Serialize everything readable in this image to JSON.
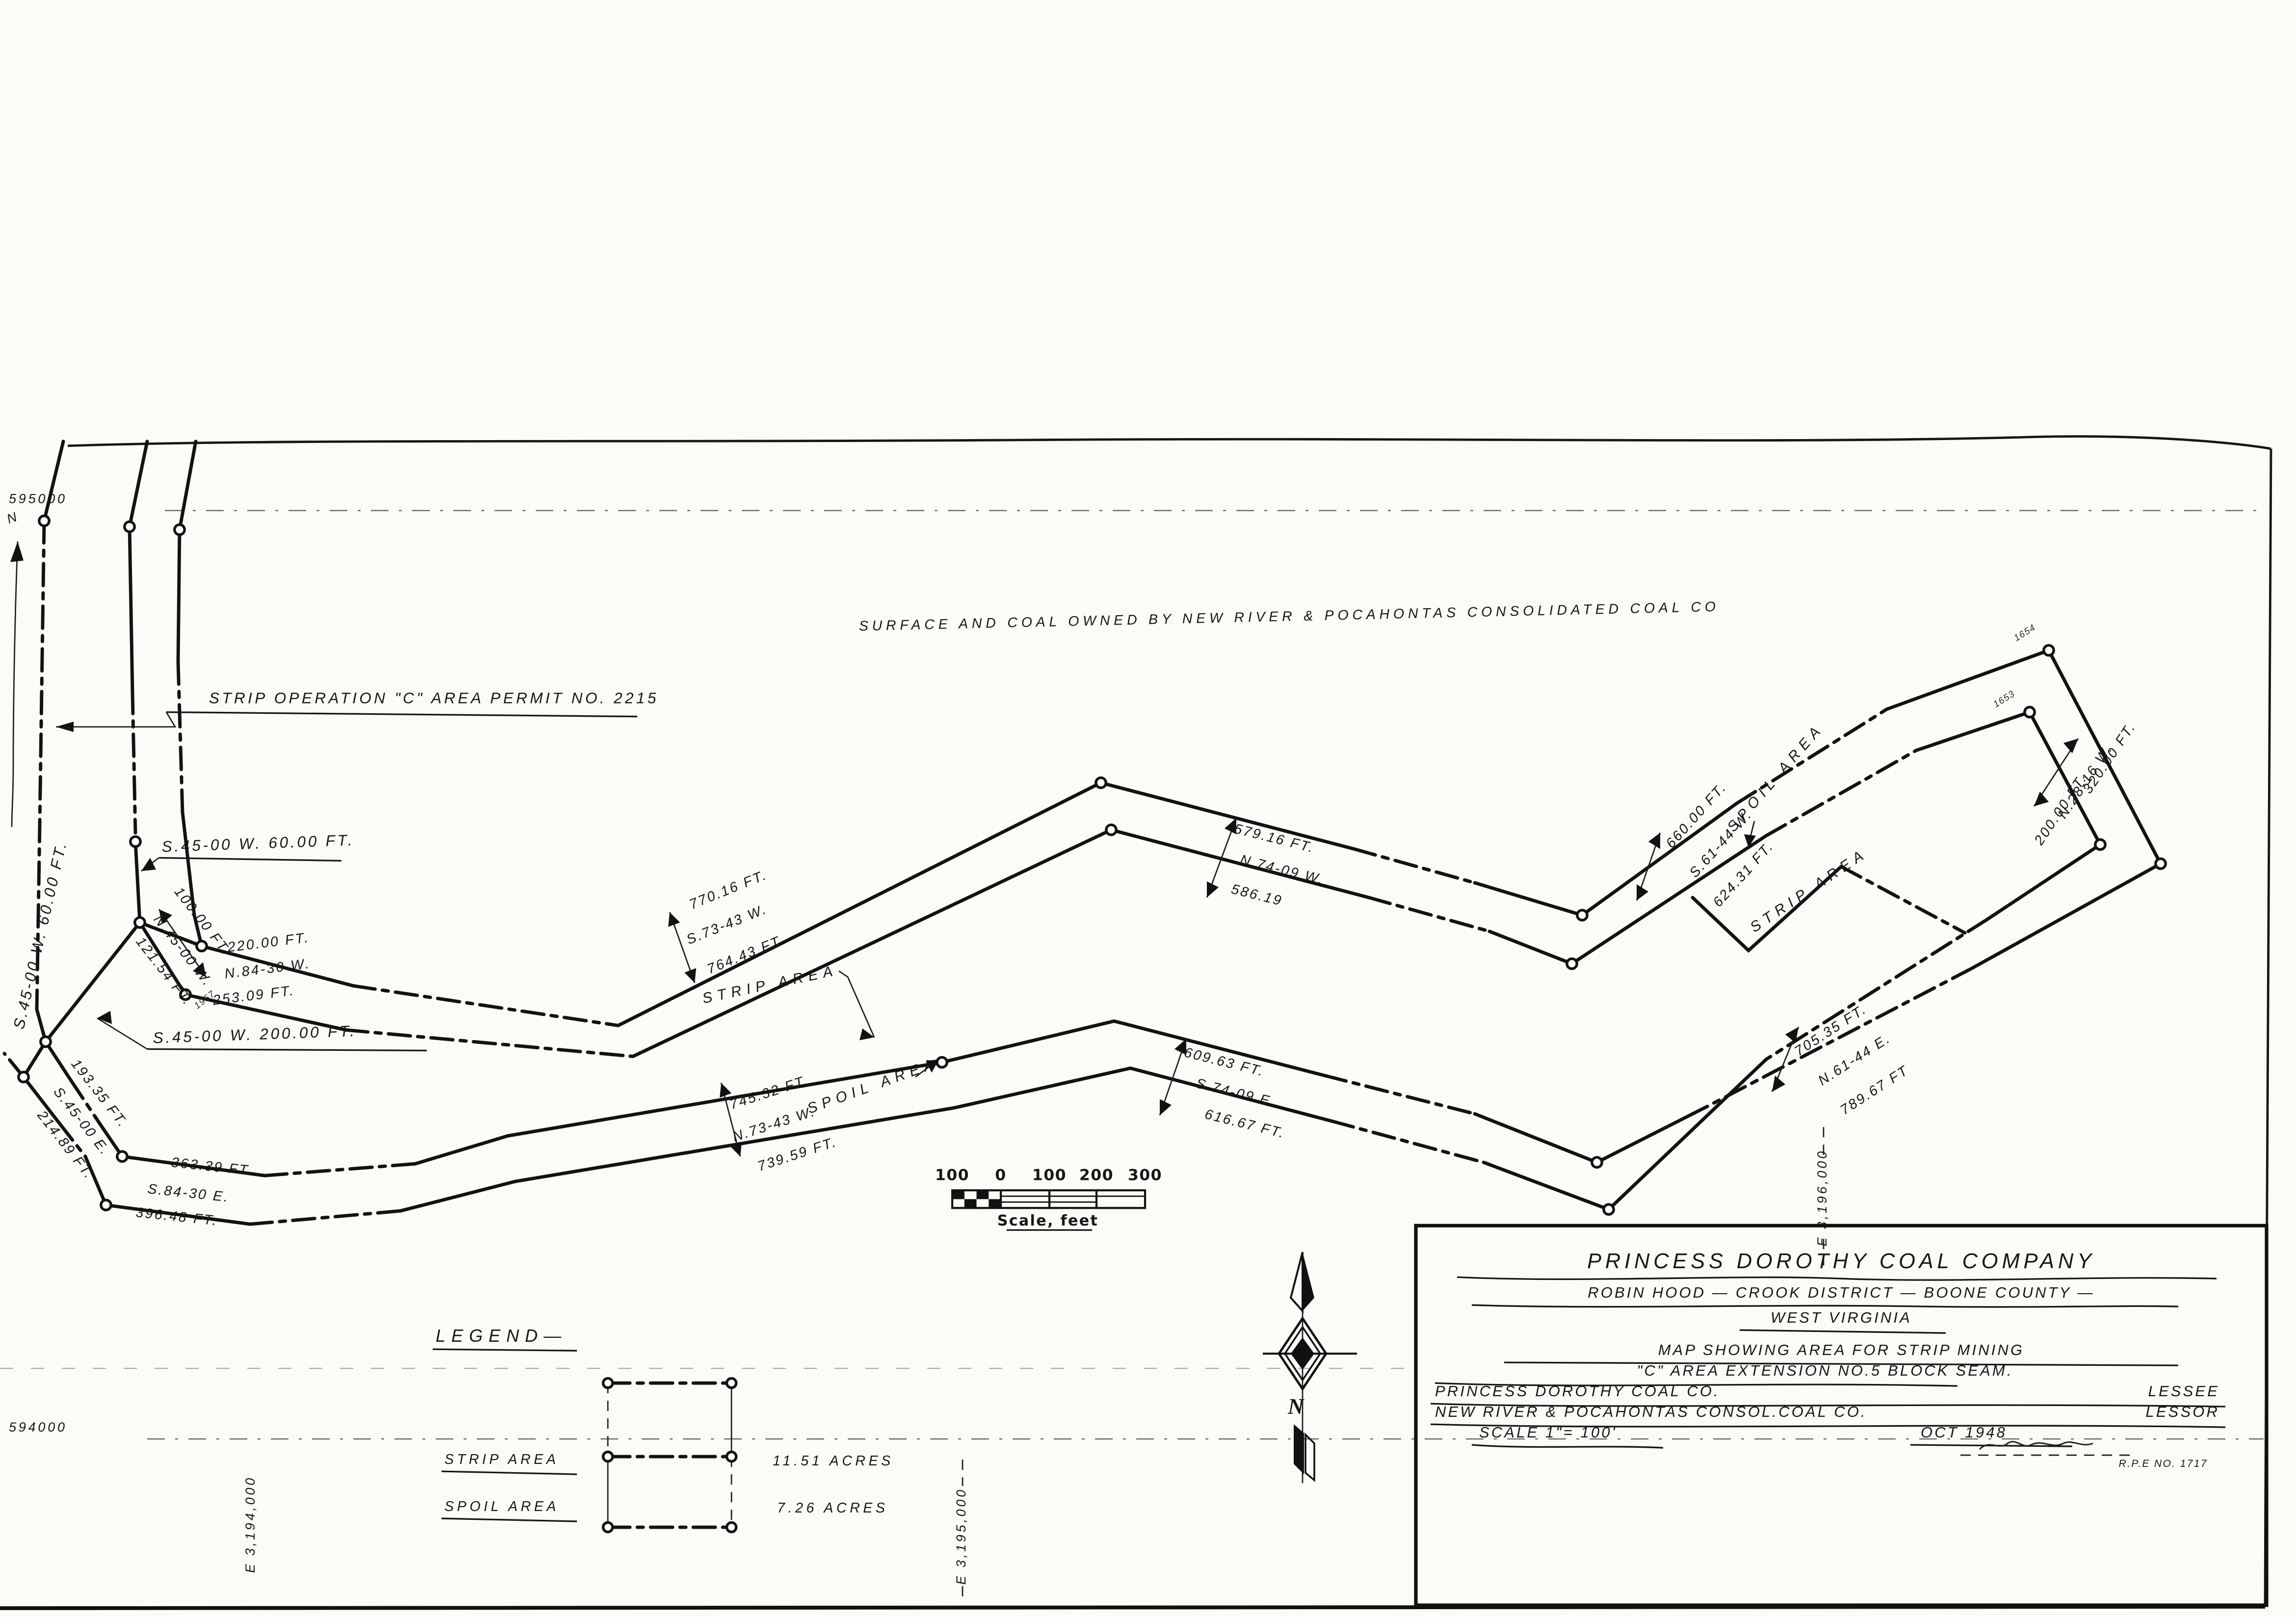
{
  "sheet": {
    "ownership_note": "SURFACE AND COAL OWNED BY NEW RIVER & POCAHONTAS CONSOLIDATED COAL CO",
    "permit_note": "STRIP OPERATION \"C\" AREA PERMIT NO. 2215"
  },
  "grid_labels": {
    "n595": "595000",
    "n594": "594000",
    "e3194": "E 3,194,000",
    "e3195": "E 3,195,000",
    "e3196": "E 3,196,000"
  },
  "compass": {
    "north_small": "N",
    "north_large": "N"
  },
  "scale_bar": {
    "ticks": [
      "100",
      "0",
      "100",
      "200",
      "300"
    ],
    "caption": "Scale, feet"
  },
  "legend": {
    "title": "LEGEND—",
    "items": [
      {
        "label": "STRIP AREA",
        "value": "11.51 ACRES"
      },
      {
        "label": "SPOIL AREA",
        "value": "7.26 ACRES"
      }
    ]
  },
  "area_labels": {
    "strip_left": "STRIP AREA",
    "spoil_left": "SPOIL AREA",
    "spoil_right": "SPOIL AREA",
    "strip_right": "STRIP AREA"
  },
  "measurements": [
    {
      "text": "S.45-00 W. 60.00 FT."
    },
    {
      "text": "100.00 FT."
    },
    {
      "text": "N.45-00 W."
    },
    {
      "text": "121.54 FT."
    },
    {
      "text": "220.00 FT."
    },
    {
      "text": "N.84-30 W."
    },
    {
      "text": "253.09 FT."
    },
    {
      "text": "S.45-00 W. 200.00 FT."
    },
    {
      "text": "193.35 FT."
    },
    {
      "text": "S.45-00 E."
    },
    {
      "text": "214.89 FT."
    },
    {
      "text": "363.39 FT."
    },
    {
      "text": "S.84-30 E."
    },
    {
      "text": "396.48 FT."
    },
    {
      "text": "770.16 FT."
    },
    {
      "text": "S.73-43 W."
    },
    {
      "text": "764.43 FT."
    },
    {
      "text": "745.32 FT."
    },
    {
      "text": "N.73-43 W."
    },
    {
      "text": "739.59 FT."
    },
    {
      "text": "579.16 FT."
    },
    {
      "text": "N.74-09 W."
    },
    {
      "text": "586.19"
    },
    {
      "text": "609.63 FT."
    },
    {
      "text": "S.74-09 E."
    },
    {
      "text": "616.67 FT."
    },
    {
      "text": "660.00 FT."
    },
    {
      "text": "S.61-44 W."
    },
    {
      "text": "624.31 FT."
    },
    {
      "text": "320.00 FT."
    },
    {
      "text": "N.28-16 W."
    },
    {
      "text": "200.00 FT."
    },
    {
      "text": "705.35 FT."
    },
    {
      "text": "N.61-44 E."
    },
    {
      "text": "789.67 FT"
    }
  ],
  "stations": [
    {
      "text": "1654"
    },
    {
      "text": "1653"
    },
    {
      "text": "1957"
    }
  ],
  "title_block": {
    "company": "PRINCESS DOROTHY COAL COMPANY",
    "district": "ROBIN HOOD — CROOK DISTRICT — BOONE COUNTY —",
    "state": "WEST VIRGINIA",
    "subject1": "MAP SHOWING AREA FOR STRIP MINING",
    "subject2": "\"C\" AREA  EXTENSION  NO.5 BLOCK SEAM.",
    "lessee_name": "PRINCESS DOROTHY COAL CO.",
    "lessee_role": "LESSEE",
    "lessor_name": "NEW RIVER & POCAHONTAS CONSOL.COAL CO.",
    "lessor_role": "LESSOR",
    "scale": "SCALE  1\"= 100'",
    "date": "OCT  1948",
    "rpe": "R.P.E  NO. 1717"
  }
}
